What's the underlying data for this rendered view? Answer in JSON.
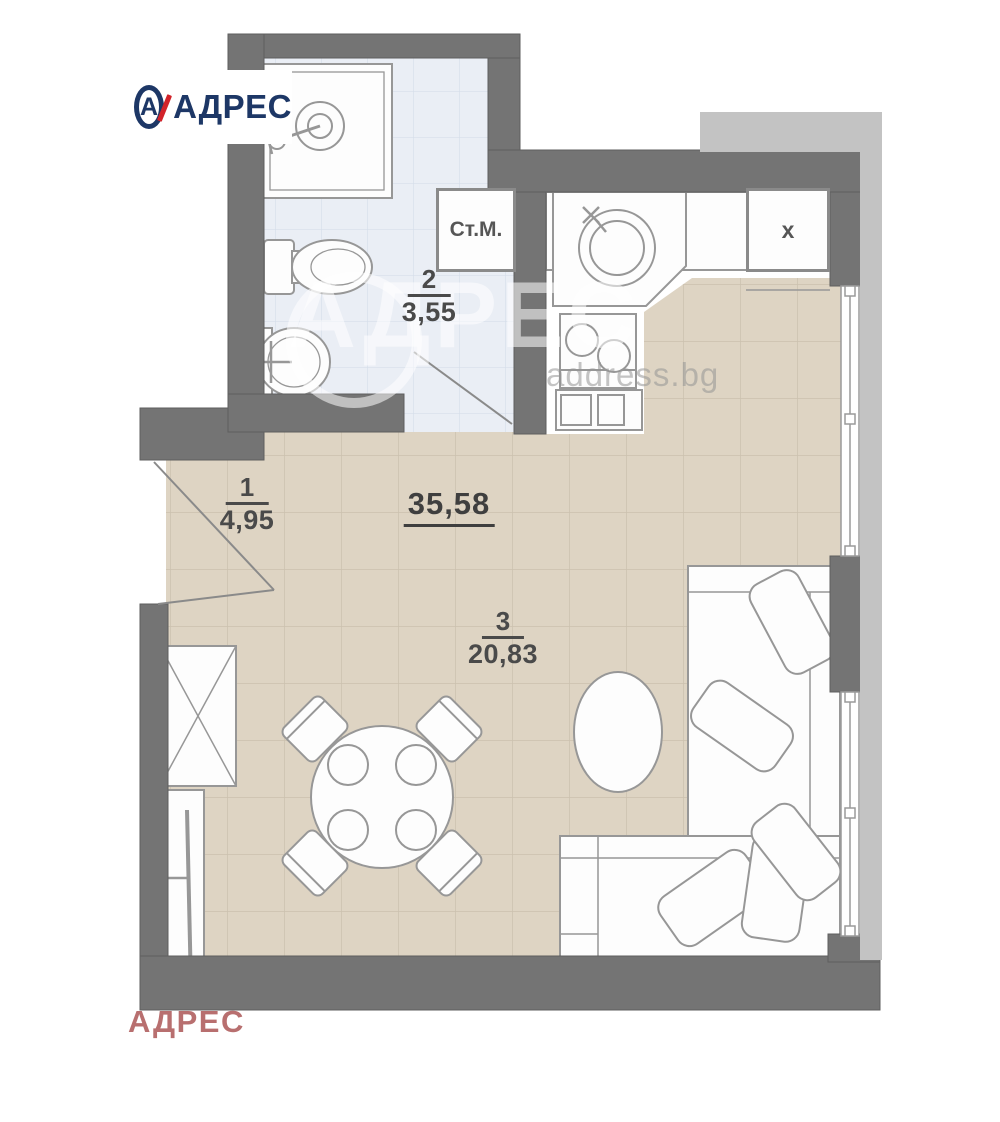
{
  "branding": {
    "logo": {
      "text": "АДРЕС",
      "icon_letter": "А"
    },
    "watermark_center": {
      "text": "АДРЕС",
      "domain": "address.bg"
    },
    "watermark_bottom": "АДРЕС"
  },
  "plan": {
    "type": "apartment-floor-plan",
    "total_area": "35,58",
    "rooms": [
      {
        "number": "1",
        "area": "4,95"
      },
      {
        "number": "2",
        "area": "3,55"
      },
      {
        "number": "3",
        "area": "20,83"
      }
    ],
    "storage_label": "Ст.М.",
    "appliance_label": "x"
  },
  "colors": {
    "wall_dark": "#747474",
    "wall_outer_band": "#c3c3c3",
    "floor_main": "#ded4c3",
    "floor_tile_line": "#cbc0ae",
    "floor_bath": "#eaeef5",
    "bath_tile_line": "#d6deea",
    "furniture_stroke": "#979797",
    "logo_navy": "#1d3766",
    "logo_red": "#d2232a",
    "label_text": "#4a4a4a",
    "watermark_bottom_red": "#ab5656"
  }
}
